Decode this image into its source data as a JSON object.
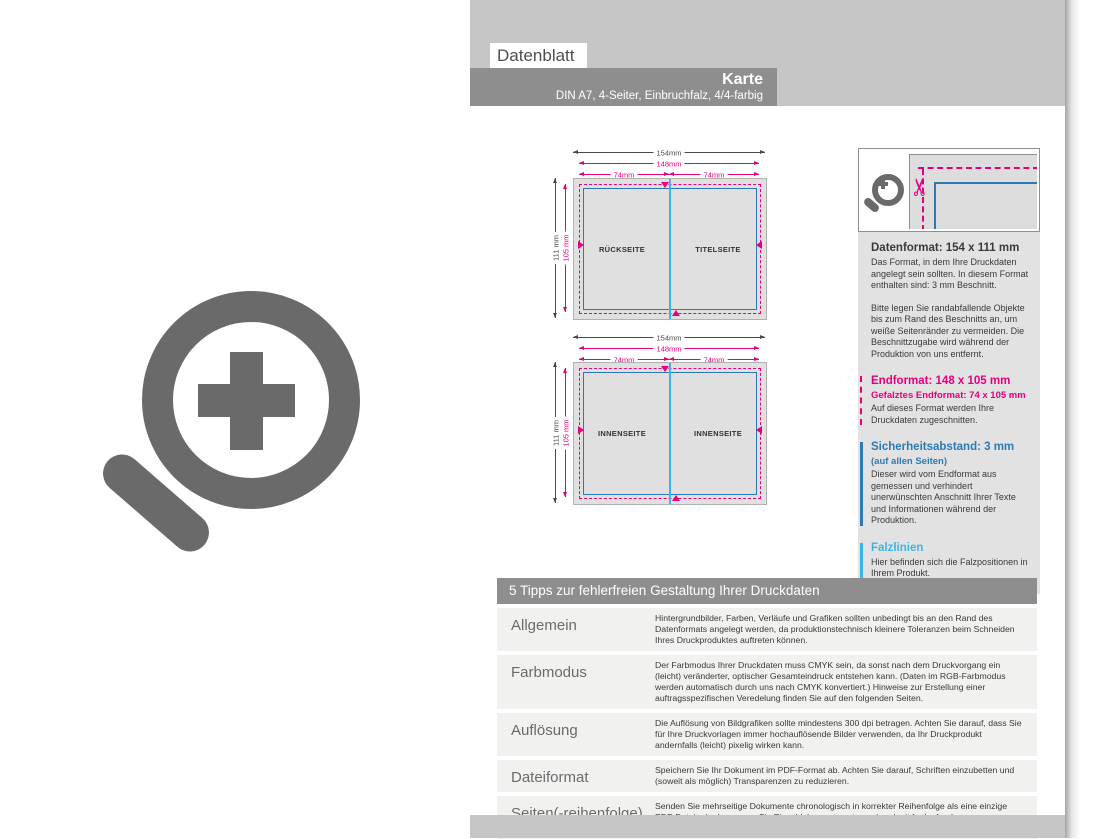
{
  "header": {
    "tab": "Datenblatt",
    "title": "Karte",
    "subtitle": "DIN A7, 4-Seiter, Einbruchfalz, 4/4-farbig"
  },
  "diagrams": {
    "dims": {
      "total_w": "154mm",
      "trim_w": "148mm",
      "half_w_left": "74mm",
      "half_w_right": "74mm",
      "total_h": "111 mm",
      "trim_h": "105 mm"
    },
    "sheet_outer": {
      "left": "RÜCKSEITE",
      "right": "TITELSEITE"
    },
    "sheet_inner": {
      "left": "INNENSEITE",
      "right": "INNENSEITE"
    }
  },
  "panel": {
    "icons": {
      "zoom": "magnifier-plus-icon",
      "scissors": "✂"
    },
    "sections": [
      {
        "heading": "Datenformat: 154 x 111 mm",
        "p1": "Das Format, in dem Ihre Druckdaten angelegt sein sollten. In diesem Format enthalten sind: 3 mm Beschnitt.",
        "p2": "Bitte legen Sie randabfallende Objekte bis zum Rand des Beschnitts an, um weiße Seitenränder zu vermeiden. Die Beschnittzugabe wird während der Produktion von uns entfernt."
      },
      {
        "heading": "Endformat: 148 x 105 mm",
        "sub": "Gefalztes Endformat: 74 x 105 mm",
        "p1": "Auf dieses Format werden Ihre Druckdaten zugeschnitten."
      },
      {
        "heading": "Sicherheitsabstand: 3 mm",
        "sub": "(auf allen Seiten)",
        "p1": "Dieser wird vom Endformat aus gemessen und verhindert unerwünschten Anschnitt Ihrer Texte und Informationen während der Produktion."
      },
      {
        "heading": "Falzlinien",
        "p1": "Hier befinden sich die Falzpositionen in Ihrem Produkt."
      }
    ]
  },
  "tips": {
    "header": "5 Tipps zur fehlerfreien Gestaltung Ihrer Druckdaten",
    "rows": [
      {
        "label": "Allgemein",
        "text": "Hintergrundbilder, Farben, Verläufe und Grafiken sollten unbedingt bis an den Rand des Datenformats angelegt werden, da produktionstechnisch kleinere Toleranzen beim Schneiden Ihres Druckproduktes auftreten können."
      },
      {
        "label": "Farbmodus",
        "text": "Der Farbmodus Ihrer Druckdaten muss CMYK sein, da sonst nach dem Druckvorgang ein (leicht) veränderter, optischer Gesamteindruck entstehen kann. (Daten im RGB-Farbmodus werden automatisch durch uns nach CMYK konvertiert.) Hinweise zur Erstellung einer auftragsspezifischen Veredelung finden Sie auf den folgenden Seiten."
      },
      {
        "label": "Auflösung",
        "text": "Die Auflösung von Bildgrafiken sollte mindestens 300 dpi betragen. Achten Sie darauf, dass Sie für Ihre Druckvorlagen immer hochauflösende Bilder verwenden, da Ihr Druckprodukt andernfalls (leicht) pixelig wirken kann."
      },
      {
        "label": "Dateiformat",
        "text": "Speichern Sie Ihr Dokument im PDF-Format ab. Achten Sie darauf, Schriften einzubetten und (soweit als möglich) Transparenzen zu reduzieren."
      },
      {
        "label": "Seiten(-reihenfolge)",
        "text": "Senden Sie mehrseitige Dokumente chronologisch in korrekter Reihenfolge als eine einzige PDF-Datei oder benennen Sie Einzeldokumente entsprechend mit fortlaufenden Seitennummern."
      }
    ]
  },
  "colors": {
    "accent_magenta": "#e5007d",
    "accent_blue": "#2a7ab5",
    "accent_cyan": "#3cb4e5",
    "bar_gray": "#8f8e8e",
    "band_gray": "#c7c6c6",
    "icon_gray": "#6a6a6a"
  }
}
